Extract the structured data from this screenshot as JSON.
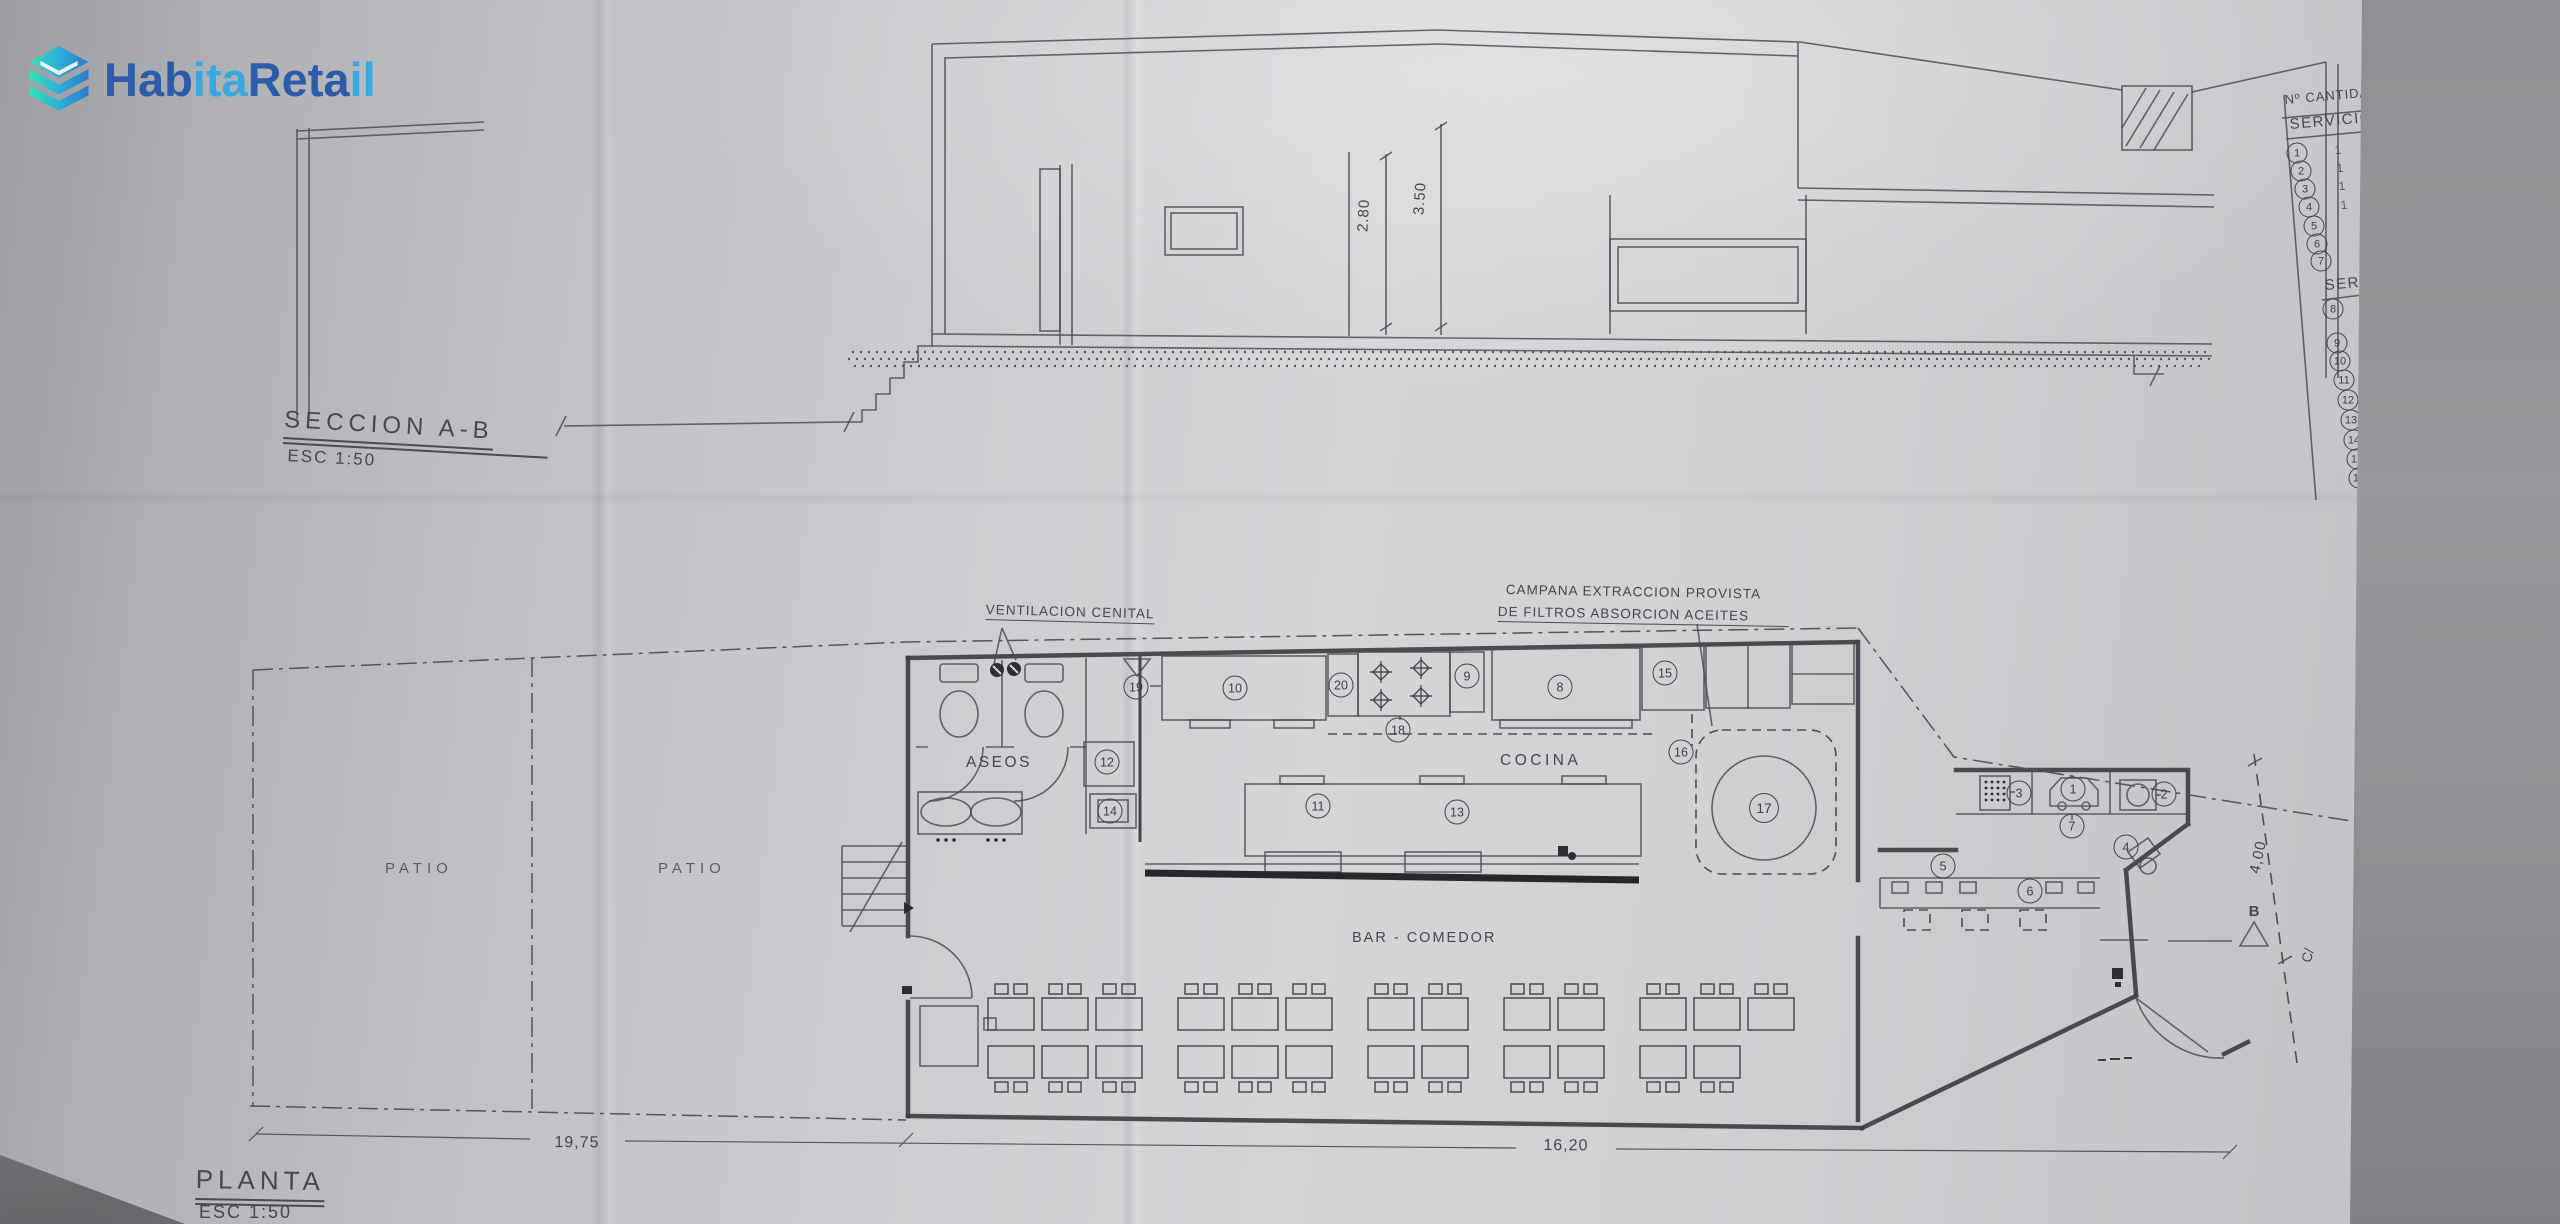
{
  "logo": {
    "part_dark_1": "Hab",
    "part_light_1": "ita",
    "part_dark_2": "Reta",
    "part_light_2": "il",
    "brand_dark": "#2a5caa",
    "brand_light": "#36a9e1",
    "icon_teal": "#35e2ae",
    "icon_blue": "#2d7cd0"
  },
  "section": {
    "title": "SECCION A-B",
    "scale": "ESC 1:50",
    "dims": {
      "h1": "2.80",
      "h2": "3.50"
    }
  },
  "plan": {
    "title": "PLANTA",
    "scale": "ESC 1:50",
    "rooms": {
      "patio": "PATIO",
      "aseos": "ASEOS",
      "cocina": "COCINA",
      "bar_comedor": "BAR - COMEDOR"
    },
    "notes": {
      "ventilacion": "VENTILACION CENITAL",
      "campana_1": "CAMPANA EXTRACCION PROVISTA",
      "campana_2": "DE FILTROS ABSORCION ACEITES"
    },
    "dims": {
      "left": "19,75",
      "right": "16,20",
      "side": "4,00"
    },
    "section_marker": "B",
    "street_label": "C/",
    "markers": [
      "1",
      "2",
      "3",
      "4",
      "5",
      "6",
      "7",
      "8",
      "9",
      "10",
      "11",
      "12",
      "13",
      "14",
      "15",
      "16",
      "17",
      "18",
      "19",
      "20"
    ]
  },
  "legend": {
    "header_qty": "Nº CANTIDAD",
    "header_servicio": "SERVICIO",
    "header_serv_2": "SERV",
    "quantities": [
      "1",
      "1",
      "1",
      "1"
    ],
    "numbers": [
      "1",
      "2",
      "3",
      "4",
      "5",
      "6",
      "7",
      "8",
      "9",
      "10",
      "11",
      "12",
      "13",
      "14",
      "15",
      "16"
    ]
  }
}
